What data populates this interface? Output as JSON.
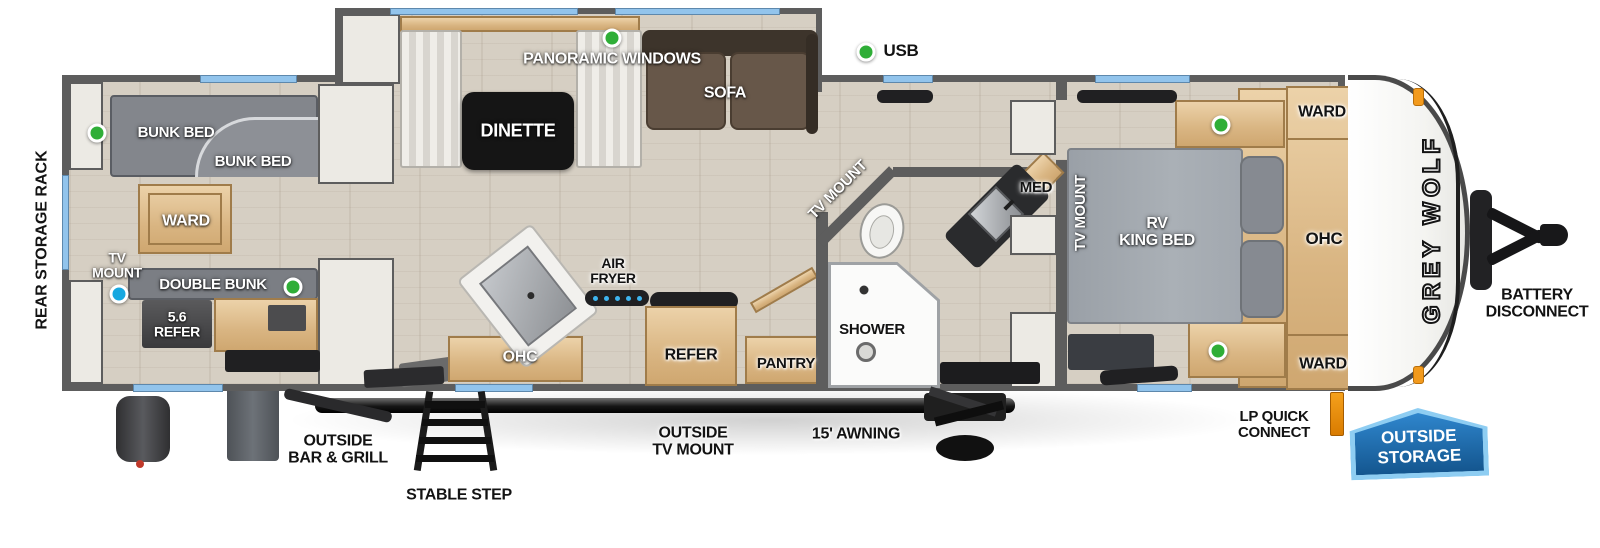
{
  "legend": {
    "usb": "USB"
  },
  "exterior": {
    "rear_storage_rack": "REAR STORAGE RACK",
    "outside_bar_grill": "OUTSIDE BAR & GRILL",
    "stable_step": "STABLE STEP",
    "outside_tv_mount": "OUTSIDE TV MOUNT",
    "awning": "15' AWNING",
    "lp_quick_connect": "LP QUICK CONNECT",
    "outside_storage": "OUTSIDE STORAGE",
    "battery_disconnect": "BATTERY DISCONNECT",
    "brand_logo": "GREY WOLF"
  },
  "bunk_room": {
    "bunk_bed_upper": "BUNK BED",
    "bunk_bed_lower": "BUNK BED",
    "ward": "WARD",
    "tv_mount": "TV MOUNT",
    "double_bunk": "DOUBLE BUNK",
    "refer": "5.6 REFER"
  },
  "living_area": {
    "panoramic_windows": "PANORAMIC WINDOWS",
    "dinette": "DINETTE",
    "sofa": "SOFA"
  },
  "kitchen": {
    "air_fryer": "AIR FRYER",
    "ohc": "OHC",
    "refer": "REFER",
    "pantry": "PANTRY"
  },
  "bathroom": {
    "tv_mount": "TV MOUNT",
    "med": "MED",
    "shower": "SHOWER"
  },
  "bedroom": {
    "tv_mount": "TV MOUNT",
    "bed_line1": "RV",
    "bed_line2": "KING BED",
    "ward_front": "WARD",
    "ohc": "OHC",
    "ward_rear": "WARD"
  },
  "colors": {
    "wall_gray": "#5d5d5d",
    "floor_tan": "#d6cfc3",
    "window_blue": "#92c4ec",
    "usb_green": "#2fae37",
    "tv_blue": "#17a8e0",
    "wood_tan": "#ddb888",
    "badge_blue": "#1d6bb2",
    "badge_trim": "#8ecdf2",
    "marker_orange": "#f29a1d"
  }
}
